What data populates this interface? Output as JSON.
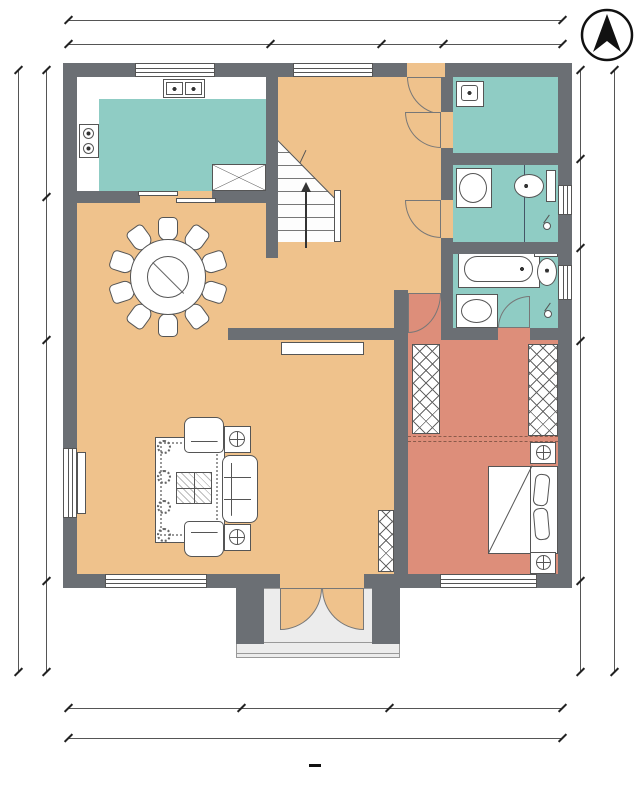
{
  "watermark": "住宅公园",
  "rooms": {
    "kitchen": "厨房",
    "fridge": "冰箱",
    "laundry": "洗衣房",
    "public_bath": "公卫",
    "ensuite_bath": "套卫",
    "dining": "餐厅",
    "cloakroom": "衣帽间",
    "hall": "堂屋",
    "living": "客厅",
    "master_bedroom": "主卧",
    "stairs_up": "上"
  },
  "dims": {
    "top": {
      "total": "12000",
      "segments": [
        "4900",
        "2700",
        "1500",
        "2900"
      ]
    },
    "left": {
      "total": "14400",
      "segments": [
        "3000",
        "3400",
        "5700",
        "2300"
      ]
    },
    "right": {
      "total": "14400",
      "segments": [
        "2100",
        "2100",
        "2200",
        "5700",
        "2300"
      ]
    },
    "bottom": {
      "total": "12000",
      "segments": [
        "4200",
        "3600",
        "4200"
      ]
    }
  },
  "title": {
    "text": "一层平面图",
    "scale": "1:100"
  },
  "colors": {
    "wall": "#6B6F74",
    "floor_hall": "#EFC28C",
    "floor_wet": "#8FCCC4",
    "floor_private": "#DD8E7A",
    "porch": "#ECECEC"
  }
}
